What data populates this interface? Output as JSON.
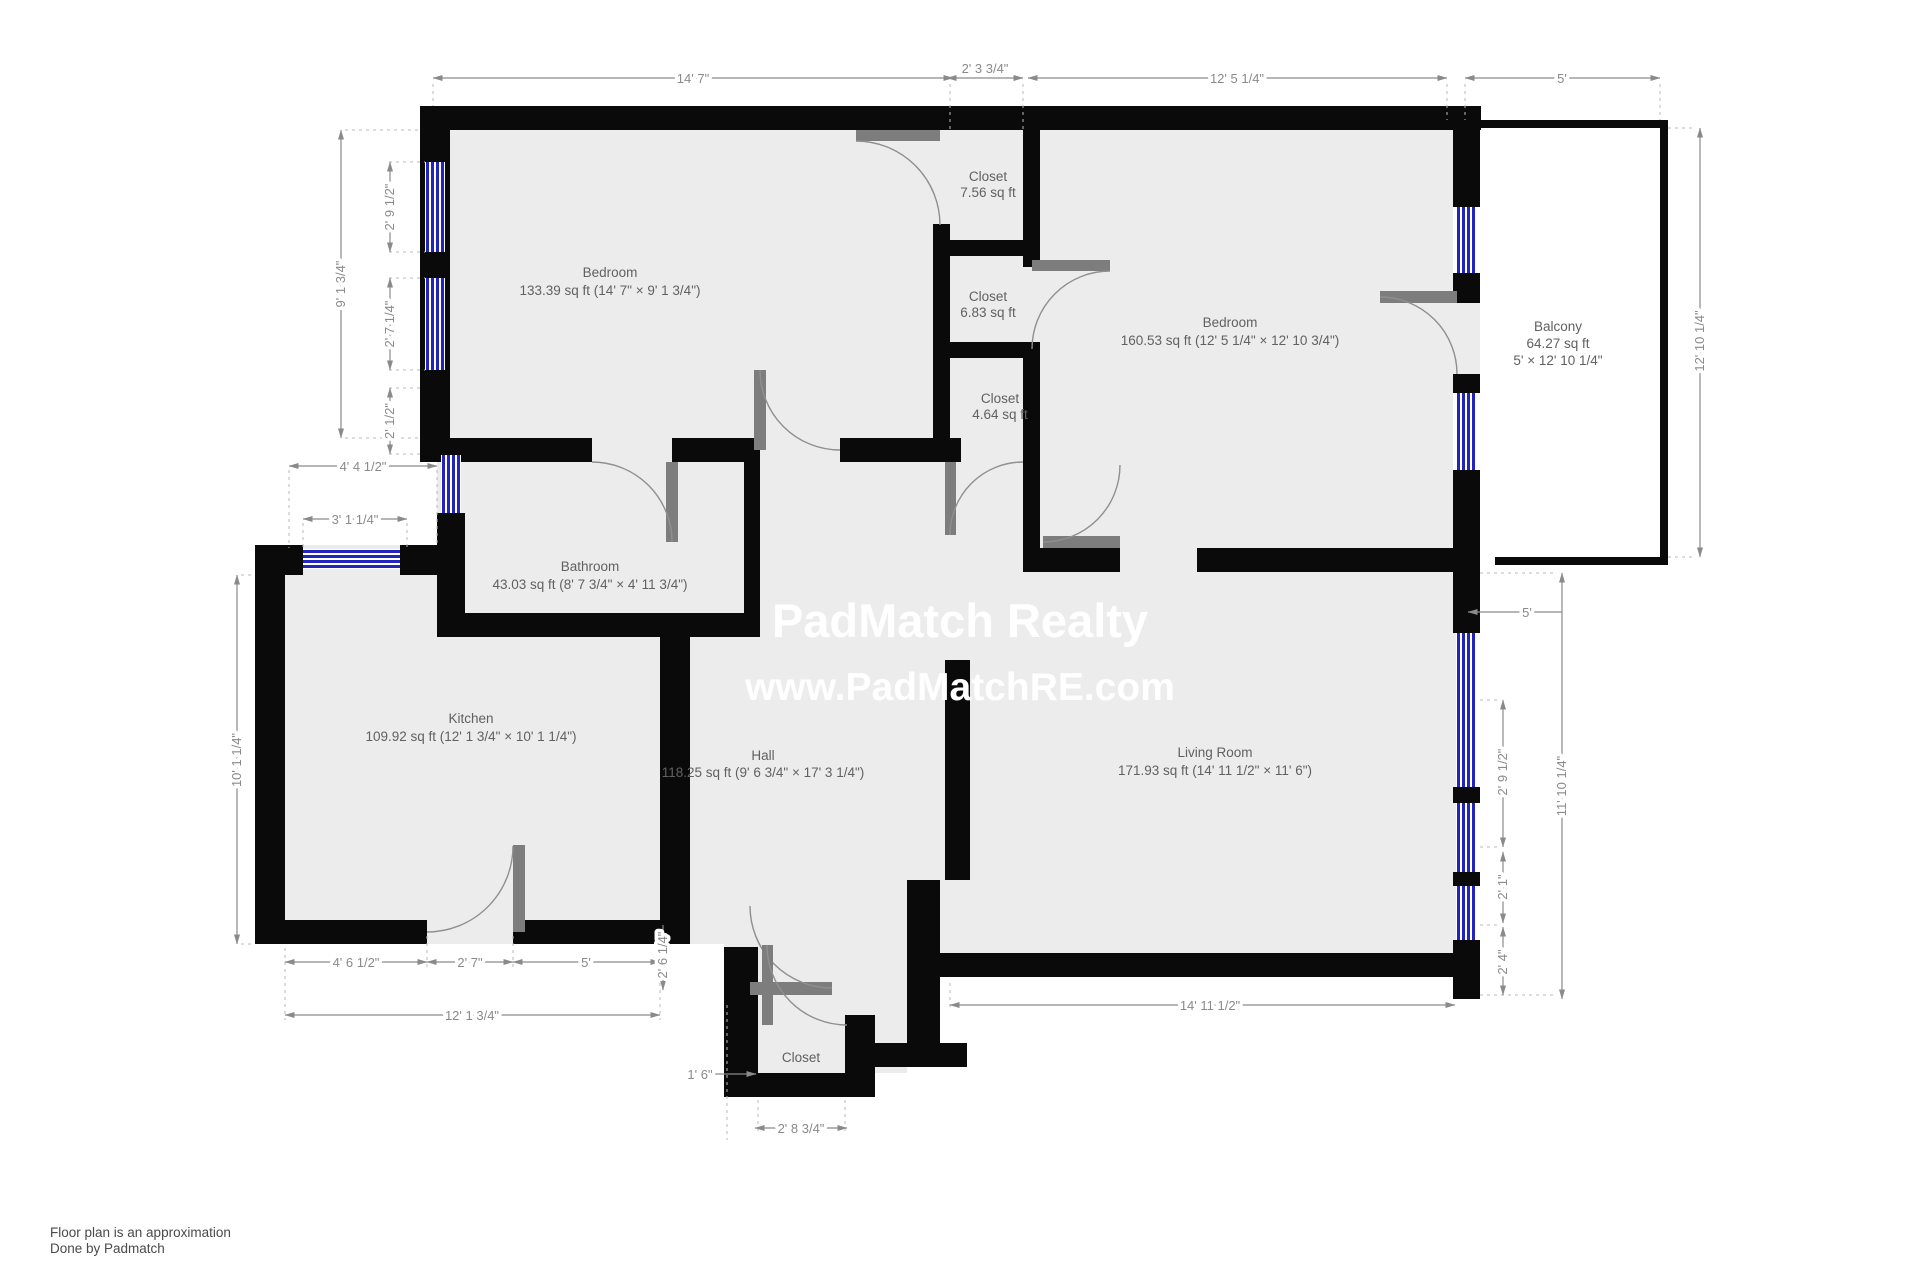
{
  "colors": {
    "wall": "#0a0a0a",
    "floor": "#ececec",
    "window_blue": "#2323bd",
    "door_gray": "#7d7d7d",
    "dim_gray": "#8a8a8a",
    "watermark": "#ffffff"
  },
  "watermark": {
    "line1": "PadMatch Realty",
    "line2": "www.PadMatchRE.com"
  },
  "footer": {
    "line1": "Floor plan is an approximation",
    "line2": "Done by Padmatch"
  },
  "rooms": {
    "bedroom1": {
      "name": "Bedroom",
      "area": "133.39 sq ft (14' 7\" × 9' 1 3/4\")"
    },
    "closet1": {
      "name": "Closet",
      "area": "7.56 sq ft"
    },
    "closet2": {
      "name": "Closet",
      "area": "6.83 sq ft"
    },
    "closet3": {
      "name": "Closet",
      "area": "4.64 sq ft"
    },
    "bedroom2": {
      "name": "Bedroom",
      "area": "160.53 sq ft (12' 5 1/4\" × 12' 10 3/4\")"
    },
    "balcony": {
      "name": "Balcony",
      "area": "64.27 sq ft",
      "dims": "5' × 12' 10 1/4\""
    },
    "bathroom": {
      "name": "Bathroom",
      "area": "43.03 sq ft (8' 7 3/4\" × 4' 11 3/4\")"
    },
    "kitchen": {
      "name": "Kitchen",
      "area": "109.92 sq ft (12' 1 3/4\" × 10' 1 1/4\")"
    },
    "hall": {
      "name": "Hall",
      "area": "118.25 sq ft (9' 6 3/4\" × 17' 3 1/4\")"
    },
    "living": {
      "name": "Living Room",
      "area": "171.93 sq ft (14' 11 1/2\" × 11' 6\")"
    },
    "entry_closet": {
      "name": "Closet"
    }
  },
  "dimensions": {
    "top_bedroom1": "14' 7\"",
    "top_closet": "2' 3 3/4\"",
    "top_bedroom2": "12' 5 1/4\"",
    "top_balcony": "5'",
    "left_bedroom1_h": "9' 1 3/4\"",
    "left_win1": "2' 9 1/2\"",
    "left_win2": "2' 7 1/4\"",
    "left_win3": "2' 1/2\"",
    "left_alcove1": "4' 4 1/2\"",
    "left_alcove2": "3' 1 1/4\"",
    "left_kitchen_h": "10' 1 1/4\"",
    "right_balcony_h": "12' 10 1/4\"",
    "right_balcony_w": "5'",
    "right_living_h": "11' 10 1/4\"",
    "right_win1": "2' 9 1/2\"",
    "right_win2": "2' 1\"",
    "right_win3": "2' 4\"",
    "bottom_kitchen1": "4' 6 1/2\"",
    "bottom_kitchen2": "2' 7\"",
    "bottom_kitchen3": "5'",
    "bottom_step": "2' 6 1/4\"",
    "bottom_kitchen_total": "12' 1 3/4\"",
    "bottom_entry": "1' 6\"",
    "bottom_closet": "2' 8 3/4\"",
    "bottom_living": "14' 11 1/2\""
  }
}
